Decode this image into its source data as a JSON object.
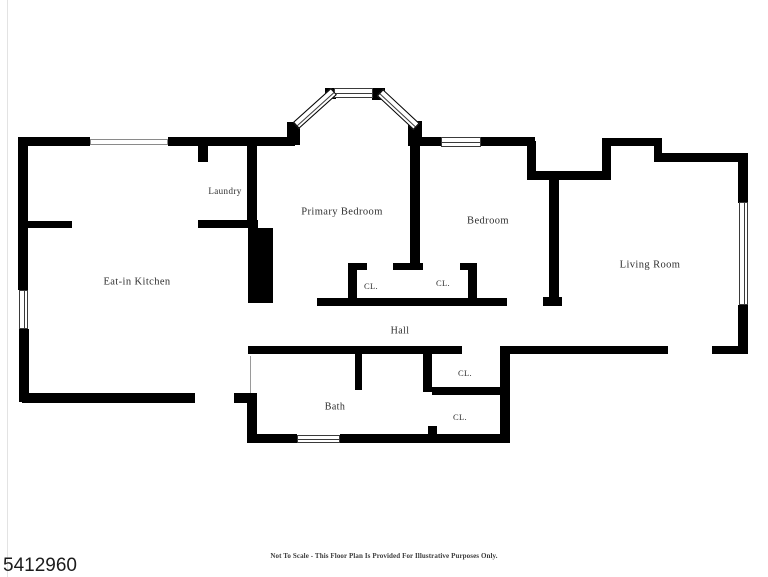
{
  "page": {
    "background": "#ffffff"
  },
  "colors": {
    "wall": "#000000",
    "label_text": "#2e2e2e"
  },
  "floor_plan": {
    "rooms": {
      "kitchen": {
        "label": "Eat-in Kitchen"
      },
      "laundry": {
        "label": "Laundry"
      },
      "primary_bedroom": {
        "label": "Primary Bedroom"
      },
      "bedroom": {
        "label": "Bedroom"
      },
      "living_room": {
        "label": "Living Room"
      },
      "hall": {
        "label": "Hall"
      },
      "bath": {
        "label": "Bath"
      },
      "closet_primary": {
        "label": "CL."
      },
      "closet_bedroom": {
        "label": "CL."
      },
      "closet_hall": {
        "label": "CL."
      },
      "closet_bath": {
        "label": "CL."
      }
    }
  },
  "footer": {
    "disclaimer": "Not To Scale - This Floor Plan Is Provided For Illustrative Purposes Only.",
    "listing_id": "5412960"
  }
}
